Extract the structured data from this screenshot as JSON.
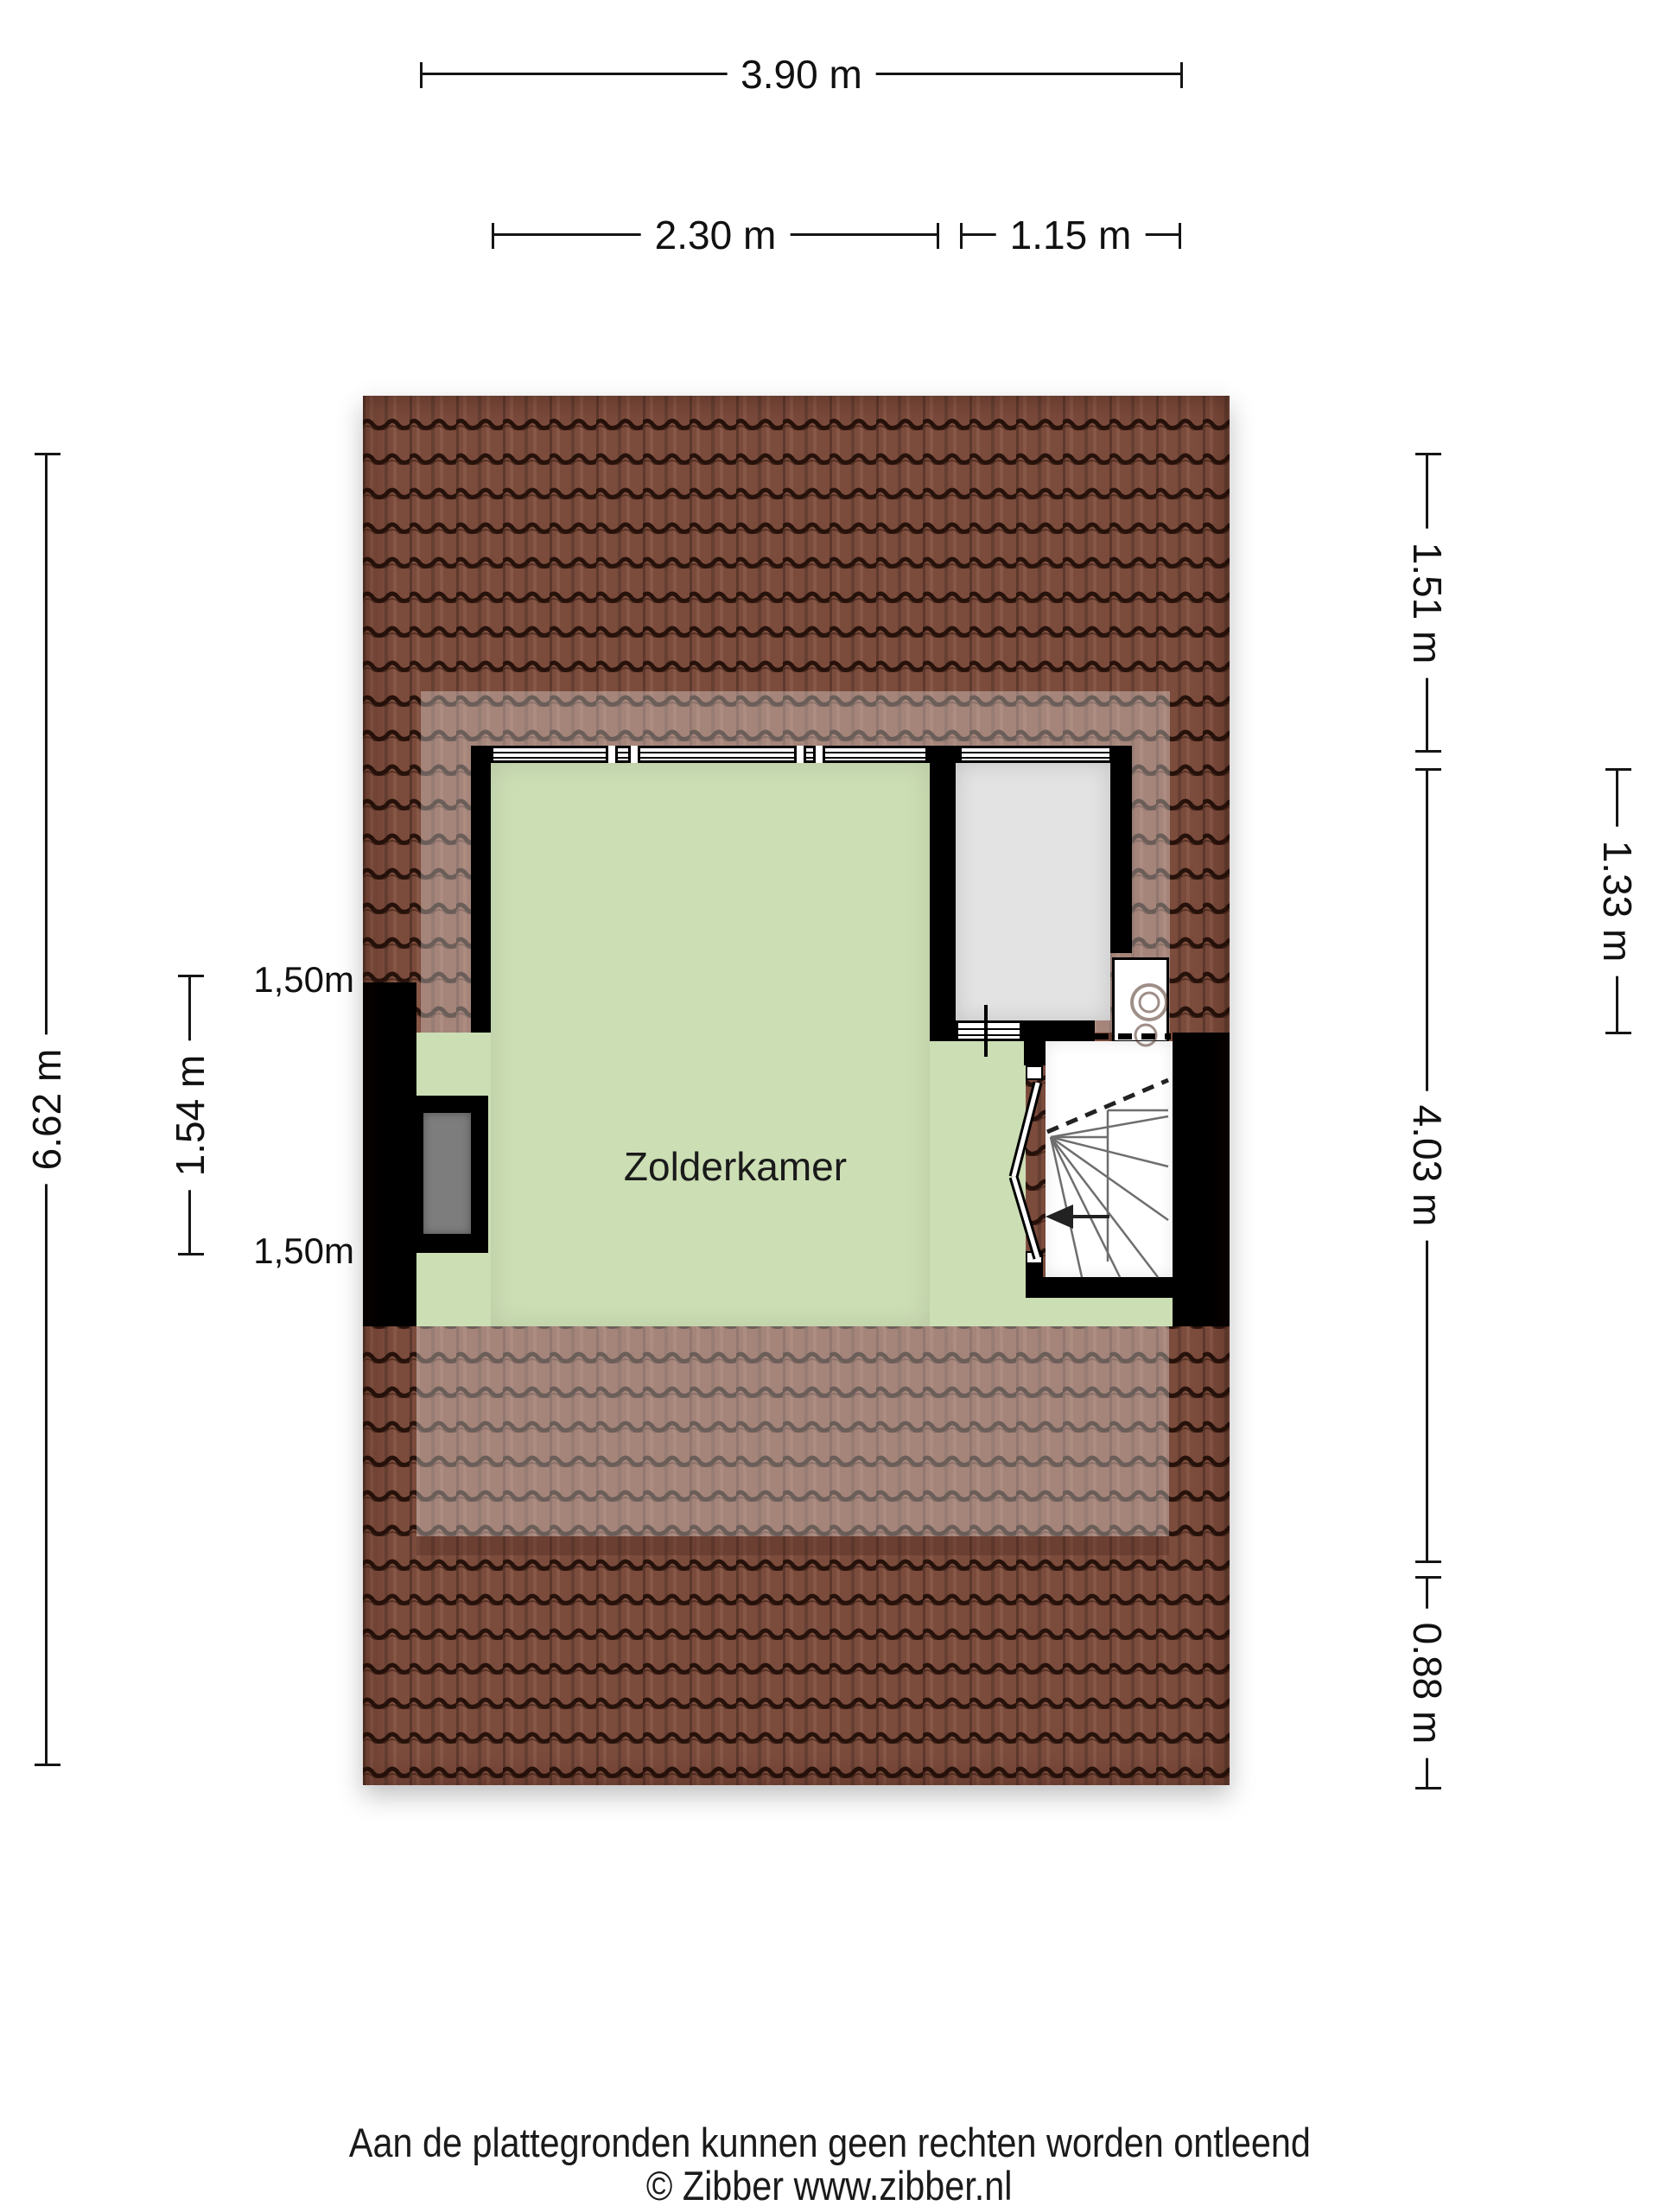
{
  "page": {
    "footer_line1": "Aan de plattegronden kunnen geen rechten worden ontleend",
    "footer_line2": "© Zibber www.zibber.nl"
  },
  "plan": {
    "room_label": "Zolderkamer",
    "height_markers": {
      "upper": "1,50m",
      "lower": "1,50m"
    }
  },
  "dimensions": {
    "top_total": "3.90 m",
    "top_left": "2.30 m",
    "top_right": "1.15 m",
    "left_total": "6.62 m",
    "left_inner": "1.54 m",
    "right_top": "1.51 m",
    "right_middle": "4.03 m",
    "right_bottom": "0.88 m",
    "right_outer": "1.33 m"
  },
  "colors": {
    "roof_tile": "#7b4b3c",
    "roof_gap": "#26120b",
    "room_green": "#ccdeb4",
    "room_gray": "#e3e3e3",
    "chimney_gray": "#7d7d7d",
    "wall_black": "#000000",
    "dimension_line": "#151515"
  }
}
